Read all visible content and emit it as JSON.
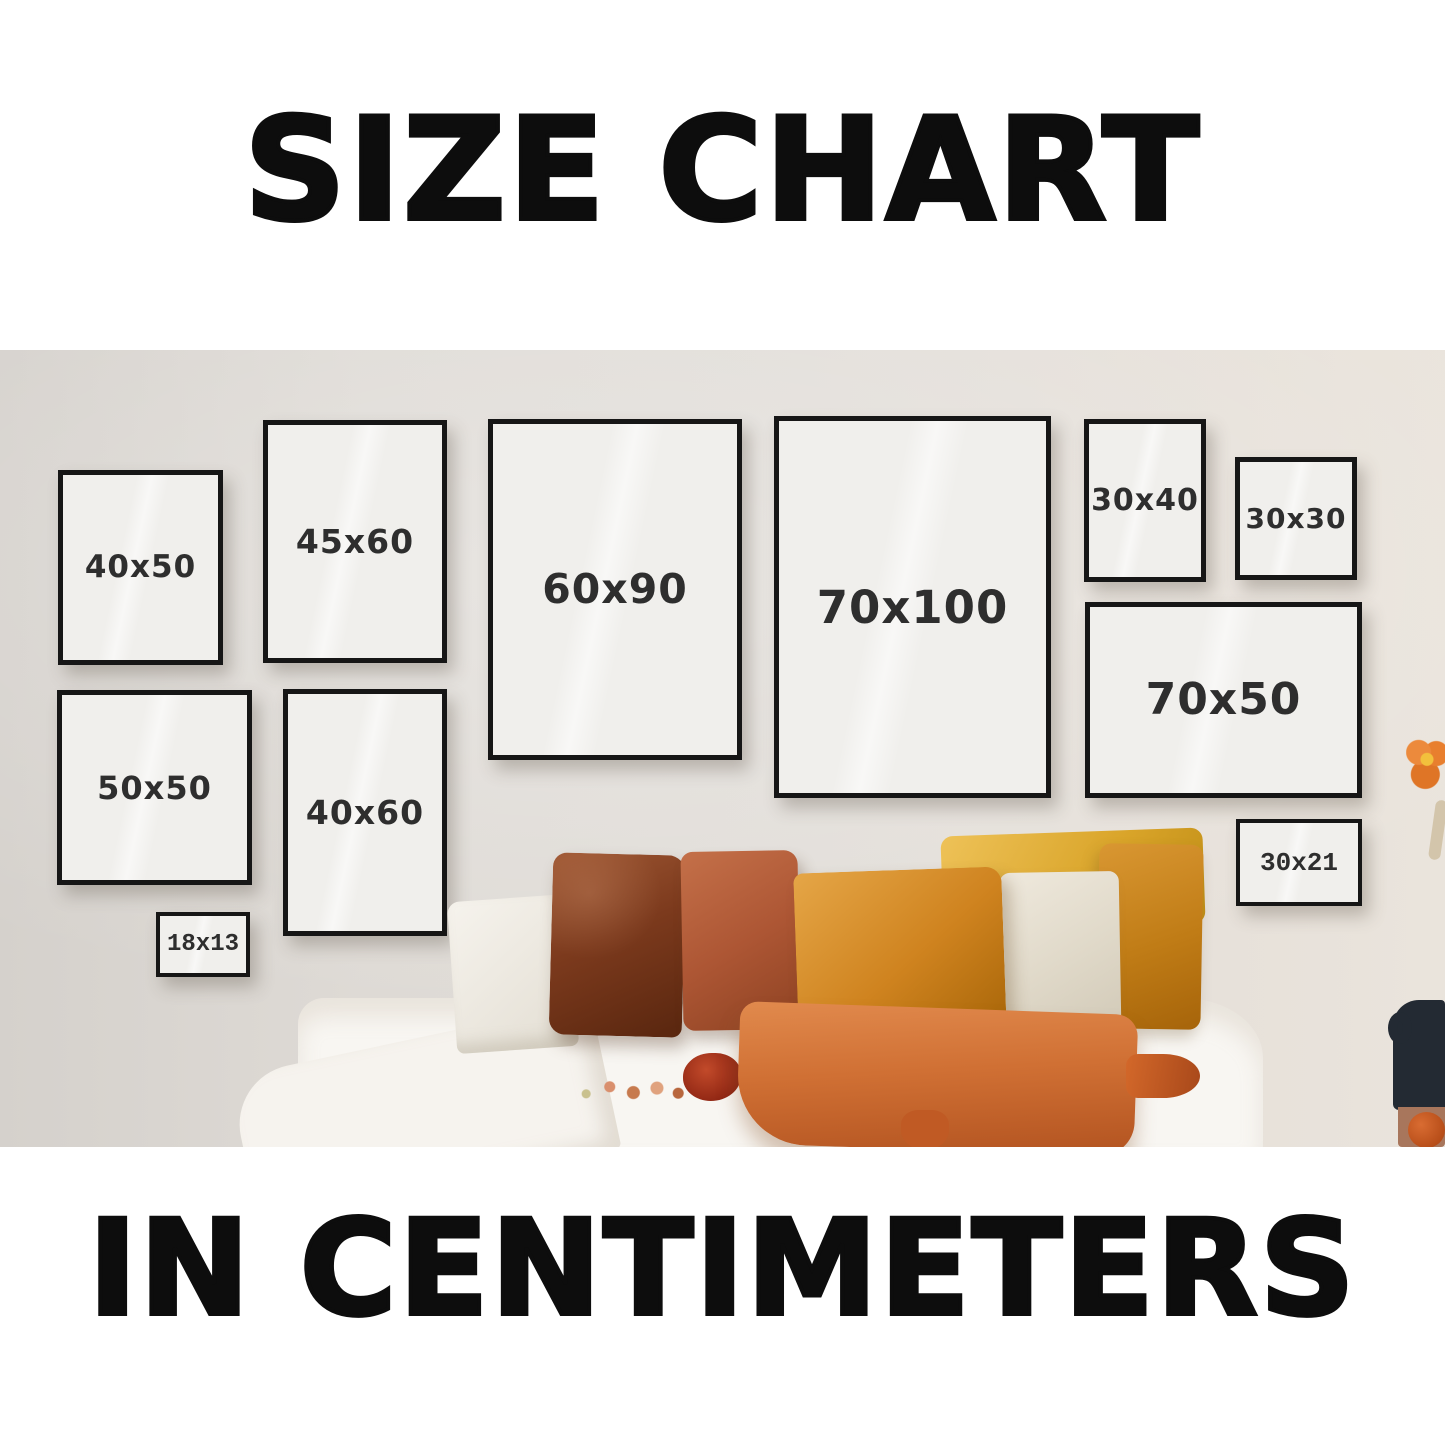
{
  "header": {
    "title": "SIZE CHART"
  },
  "footer": {
    "title": "IN CENTIMETERS"
  },
  "frames": [
    {
      "label": "40x50"
    },
    {
      "label": "45x60"
    },
    {
      "label": "60x90"
    },
    {
      "label": "70x100"
    },
    {
      "label": "30x40"
    },
    {
      "label": "30x30"
    },
    {
      "label": "50x50"
    },
    {
      "label": "40x60"
    },
    {
      "label": "70x50"
    },
    {
      "label": "30x21"
    },
    {
      "label": "18x13"
    }
  ],
  "colors": {
    "headline_text": "#0d0d0d",
    "wall": "#e0dcd7",
    "frame_border": "#161616",
    "frame_mat": "#f0efec",
    "frame_label": "#2e2e2e",
    "pillow_dark_rust": "#7c3a1d",
    "pillow_terracotta": "#ad5634",
    "pillow_amber": "#cf831f",
    "pillow_yellow": "#d9a429",
    "pillow_cream": "#e0d9c9",
    "pillow_front_orange": "#d07034",
    "bed_sheet": "#f8f6f2",
    "vase": "#232a33",
    "flower_orange": "#e87f2e"
  }
}
